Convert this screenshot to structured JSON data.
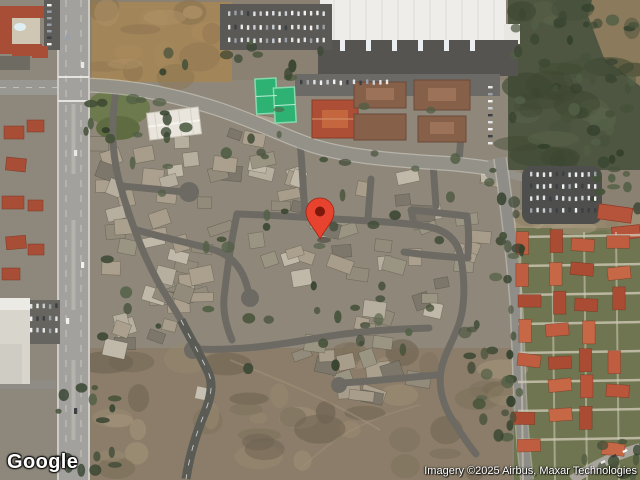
{
  "branding": {
    "logo_text": "Google"
  },
  "attribution": {
    "text": "Imagery ©2025 Airbus, Maxar Technologies"
  },
  "marker": {
    "name": "map-pin",
    "color": "#e8432f",
    "stroke": "#9c2414",
    "inner_color": "#7e180c",
    "position_px": {
      "x": 320,
      "y": 240
    }
  },
  "map": {
    "view": "satellite",
    "palette": {
      "road_major": "#a2a19d",
      "road_minor": "#6d6a64",
      "terrain_scrub": "#8b7d69",
      "terrain_dirt": "#a28559",
      "vegetation_dark": "#4e5540",
      "warehouse_roof": "#eeede9",
      "condo_roof": "#b8553a",
      "tennis_court": "#2eb273"
    }
  }
}
